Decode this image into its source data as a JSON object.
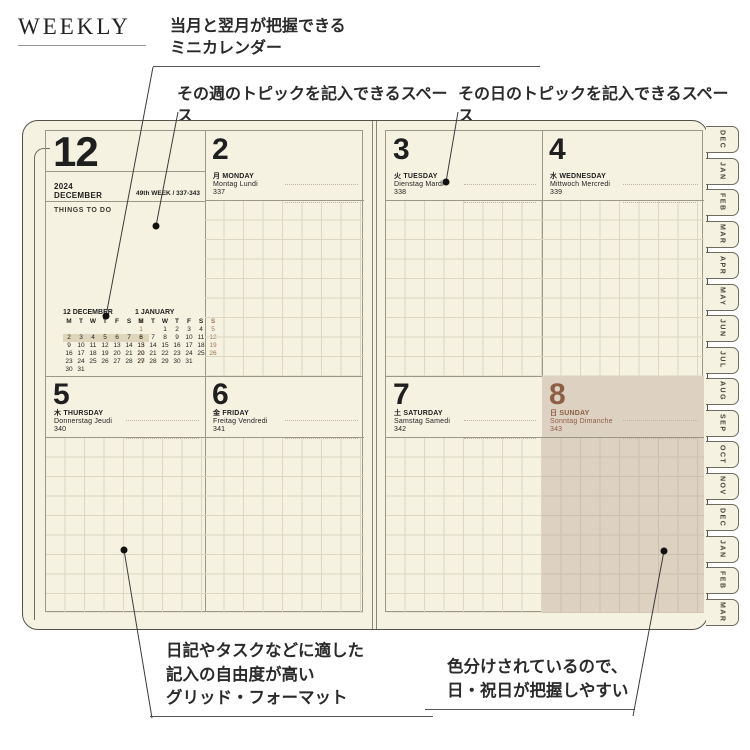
{
  "title": "WEEKLY",
  "annotations": {
    "mini_calendar_line1": "当月と翌月が把握できる",
    "mini_calendar_line2": "ミニカレンダー",
    "week_topic": "その週のトピックを記入できるスペース",
    "day_topic": "その日のトピックを記入できるスペース",
    "grid_line1": "日記やタスクなどに適した",
    "grid_line2": "記入の自由度が高い",
    "grid_line3": "グリッド・フォーマット",
    "color_line1": "色分けされているので、",
    "color_line2": "日・祝日が把握しやすい"
  },
  "planner": {
    "month_number": "12",
    "year": "2024",
    "month_name": "DECEMBER",
    "week_info": "49th WEEK / 337-343",
    "things_to_do": "THINGS TO DO",
    "mini_calendars": [
      {
        "title": "12 DECEMBER",
        "weekdays": [
          "M",
          "T",
          "W",
          "T",
          "F",
          "S",
          "S"
        ],
        "weeks": [
          [
            "",
            "",
            "",
            "",
            "",
            "",
            "1"
          ],
          [
            "2",
            "3",
            "4",
            "5",
            "6",
            "7",
            "8"
          ],
          [
            "9",
            "10",
            "11",
            "12",
            "13",
            "14",
            "15"
          ],
          [
            "16",
            "17",
            "18",
            "19",
            "20",
            "21",
            "22"
          ],
          [
            "23",
            "24",
            "25",
            "26",
            "27",
            "28",
            "29"
          ],
          [
            "30",
            "31",
            "",
            "",
            "",
            "",
            ""
          ]
        ],
        "highlight_week": 1
      },
      {
        "title": "1 JANUARY",
        "weekdays": [
          "M",
          "T",
          "W",
          "T",
          "F",
          "S",
          "S"
        ],
        "weeks": [
          [
            "",
            "",
            "1",
            "2",
            "3",
            "4",
            "5"
          ],
          [
            "6",
            "7",
            "8",
            "9",
            "10",
            "11",
            "12"
          ],
          [
            "13",
            "14",
            "15",
            "16",
            "17",
            "18",
            "19"
          ],
          [
            "20",
            "21",
            "22",
            "23",
            "24",
            "25",
            "26"
          ],
          [
            "27",
            "28",
            "29",
            "30",
            "31",
            "",
            ""
          ]
        ],
        "highlight_week": -1
      }
    ],
    "days": [
      {
        "date": "2",
        "kanji": "月",
        "name": "MONDAY",
        "intl": "Montag Lundi",
        "day_of_year": "337"
      },
      {
        "date": "3",
        "kanji": "火",
        "name": "TUESDAY",
        "intl": "Dienstag Mardi",
        "day_of_year": "338"
      },
      {
        "date": "4",
        "kanji": "水",
        "name": "WEDNESDAY",
        "intl": "Mittwoch Mercredi",
        "day_of_year": "339"
      },
      {
        "date": "5",
        "kanji": "木",
        "name": "THURSDAY",
        "intl": "Donnerstag Jeudi",
        "day_of_year": "340"
      },
      {
        "date": "6",
        "kanji": "金",
        "name": "FRIDAY",
        "intl": "Freitag Vendredi",
        "day_of_year": "341"
      },
      {
        "date": "7",
        "kanji": "土",
        "name": "SATURDAY",
        "intl": "Samstag Samedi",
        "day_of_year": "342"
      },
      {
        "date": "8",
        "kanji": "日",
        "name": "SUNDAY",
        "intl": "Sonntag Dimanche",
        "day_of_year": "343"
      }
    ],
    "tabs": [
      "DEC",
      "JAN",
      "FEB",
      "MAR",
      "APR",
      "MAY",
      "JUN",
      "JUL",
      "AUG",
      "SEP",
      "OCT",
      "NOV",
      "DEC",
      "JAN",
      "FEB",
      "MAR"
    ]
  },
  "colors": {
    "paper": "#f5f2e1",
    "ink": "#1f1f1f",
    "sunday_text": "#8c5f45",
    "sunday_bg": "#ddd1c1",
    "grid_line": "#dbd7c3",
    "sunday_grid_line": "#cdbfac",
    "rule": "#9b9789",
    "outer_border": "#55524a",
    "highlight": "#ded5bb",
    "tab_text": "#47443c",
    "leader": "#3c3c3c"
  }
}
